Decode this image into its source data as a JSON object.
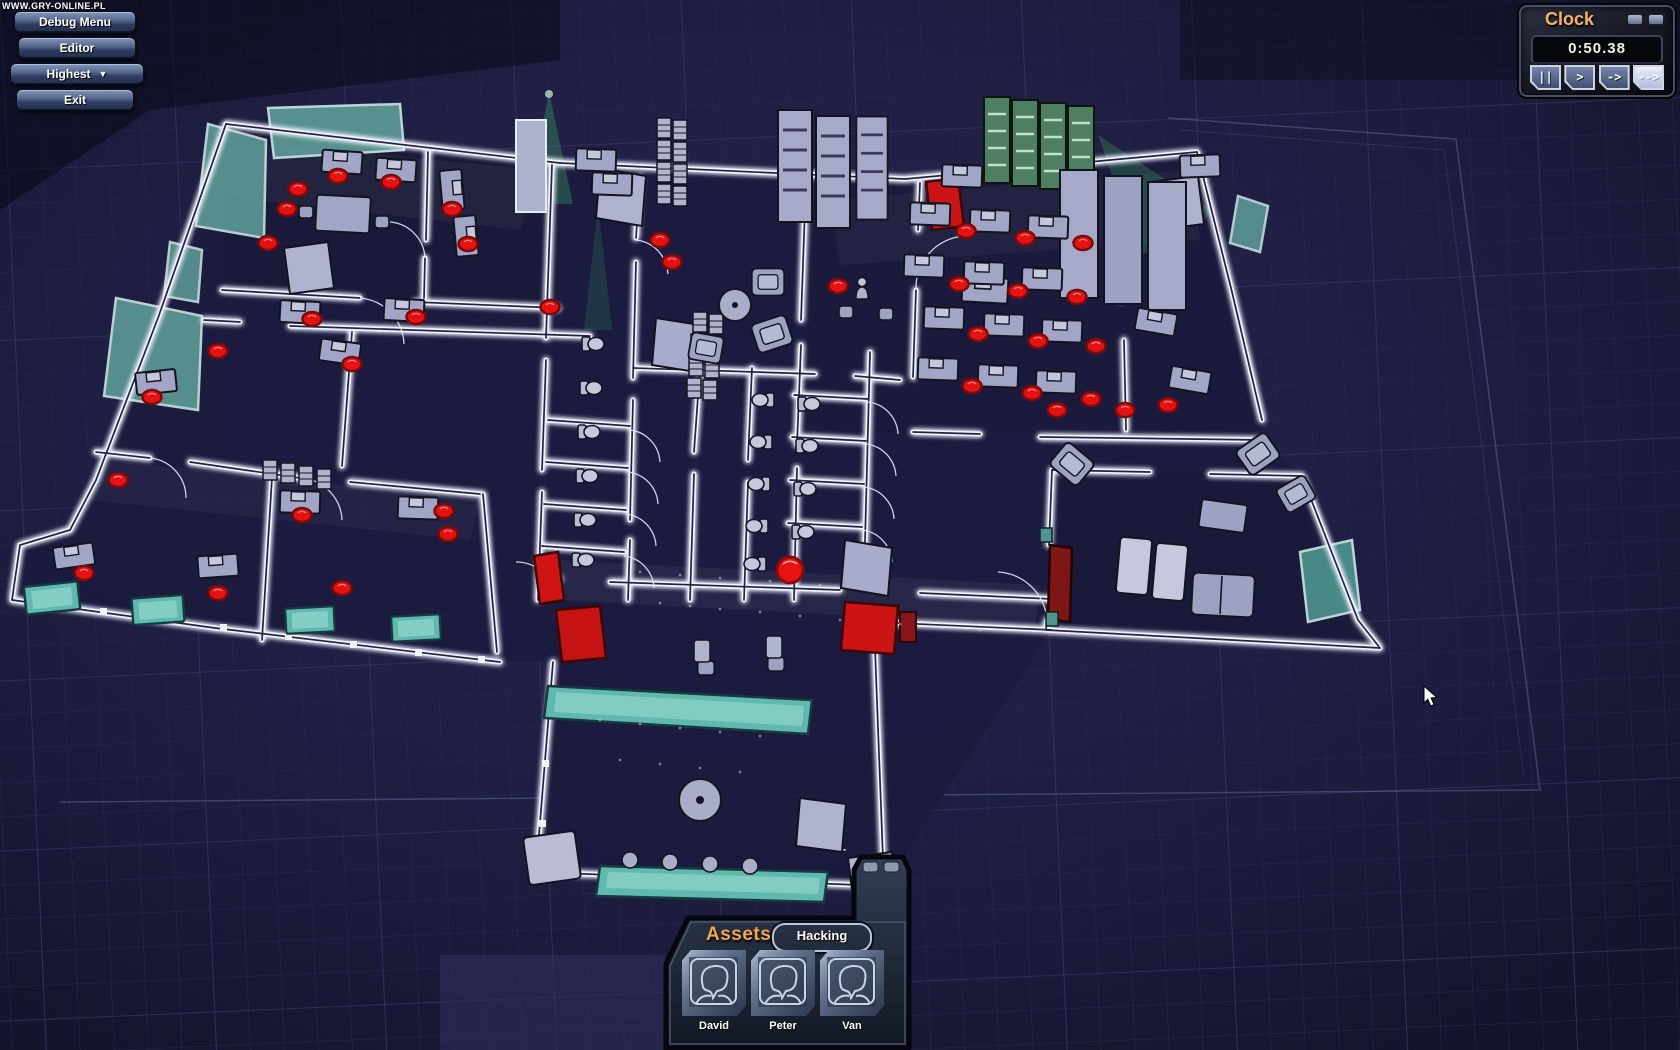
{
  "watermark": {
    "text": "WWW.GRY-ONLINE.PL"
  },
  "menu": {
    "buttons": [
      {
        "id": "debug-menu",
        "label": "Debug Menu"
      },
      {
        "id": "editor",
        "label": "Editor"
      },
      {
        "id": "highest",
        "label": "Highest",
        "dropdown_arrow": "▼"
      },
      {
        "id": "exit",
        "label": "Exit"
      }
    ]
  },
  "clock": {
    "title": "Clock",
    "time": "0:50.38",
    "speed_buttons": [
      {
        "id": "pause",
        "glyph": "||",
        "active": false
      },
      {
        "id": "play",
        "glyph": ">",
        "active": false
      },
      {
        "id": "fast",
        "glyph": "->",
        "active": false
      },
      {
        "id": "fastest",
        "glyph": "-->",
        "active": true
      }
    ]
  },
  "assets_panel": {
    "title": "Assets",
    "tab": "Hacking",
    "characters": [
      {
        "name": "David"
      },
      {
        "name": "Peter"
      },
      {
        "name": "Van"
      }
    ]
  },
  "colors": {
    "accent_orange": "#f2a64f",
    "wall_glow_white": "#f1f4ff",
    "alarm_chair_red": "#e61212",
    "security_door_red": "#cc1414",
    "glass_teal": "#5fb9ae",
    "furniture_lavender": "#a2a6c6",
    "camera_cone_green": "#46c46a",
    "background_navy": "#1c1c40"
  }
}
